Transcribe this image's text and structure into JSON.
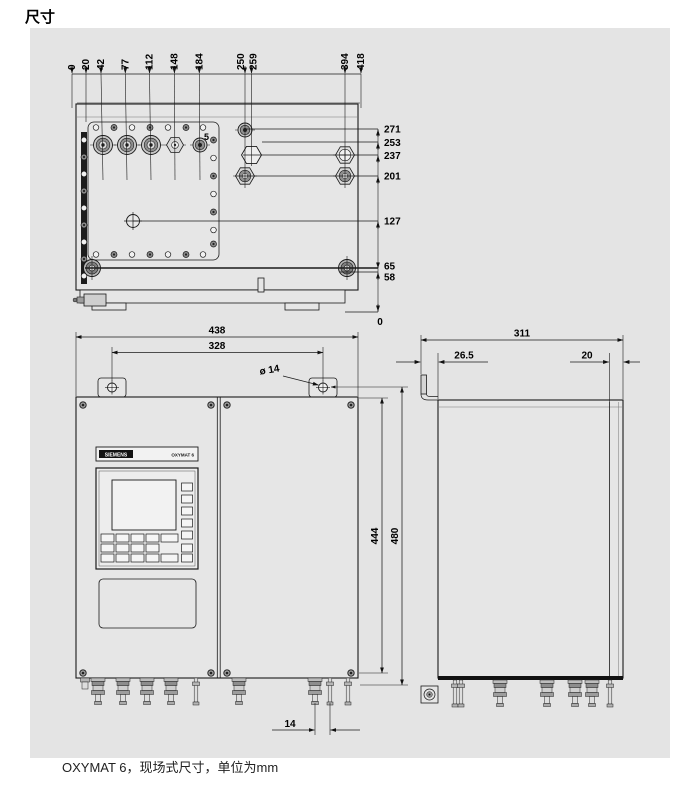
{
  "page": {
    "heading": "尺寸",
    "caption": "OXYMAT 6，现场式尺寸，单位为mm",
    "unit": "mm"
  },
  "colors": {
    "background": "#ffffff",
    "panel": "#e4e4e4",
    "ink": "#1a1a1a"
  },
  "views": {
    "top": {
      "x_dims": [
        "0",
        "20",
        "42",
        "77",
        "112",
        "148",
        "184",
        "250",
        "259",
        "394",
        "418"
      ],
      "y_dims": [
        "271",
        "253",
        "237",
        "201",
        "127",
        "65",
        "58"
      ],
      "y_zero": "0",
      "count_label": "5"
    },
    "front": {
      "overall_width": "438",
      "hole_spacing": "328",
      "hole_diameter": "ø 14",
      "gland_offset": "14",
      "device": {
        "brand": "SIEMENS",
        "model": "OXYMAT 6"
      }
    },
    "side": {
      "overall_depth": "311",
      "left_offset": "26.5",
      "right_offset": "20",
      "inner_height": "444",
      "overall_height": "480"
    }
  }
}
